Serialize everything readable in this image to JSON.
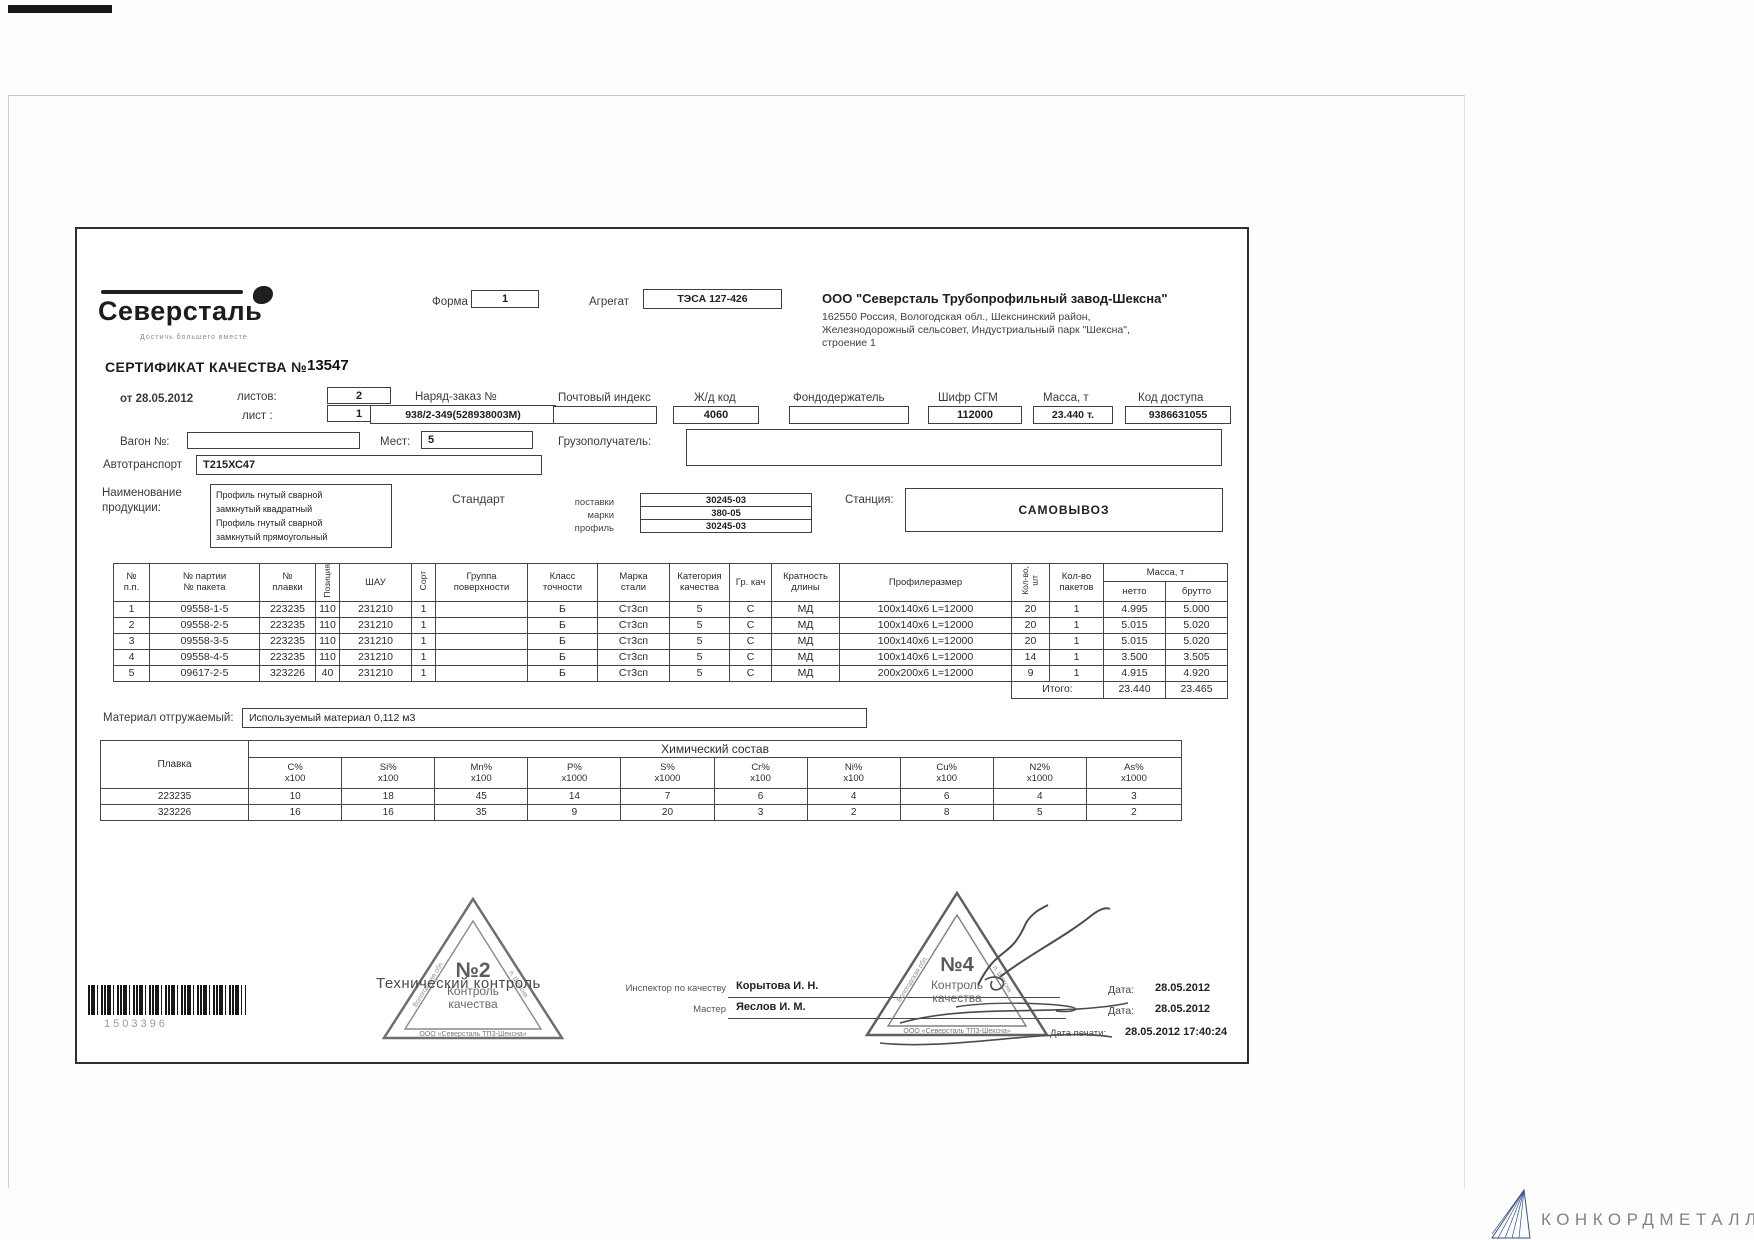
{
  "scan": {
    "barcode_number": "1503396"
  },
  "watermark": {
    "brand": "КОНКОРДМЕТАЛЛ"
  },
  "header": {
    "logo_name": "Северсталь",
    "logo_tagline": "Достичь большего вместе",
    "forma_label": "Форма",
    "forma_value": "1",
    "agregat_label": "Агрегат",
    "agregat_value": "ТЭСА 127-426",
    "company_name": "ООО \"Северсталь Трубопрофильный завод-Шексна\"",
    "company_address_1": "162550 Россия, Вологодская обл., Шекснинский район,",
    "company_address_2": "Железнодорожный сельсовет, Индустриальный парк \"Шексна\",",
    "company_address_3": "строение 1"
  },
  "certificate": {
    "title": "СЕРТИФИКАТ КАЧЕСТВА №",
    "number": "13547",
    "date_line": "от  28.05.2012",
    "listov_label": "листов:",
    "listov": "2",
    "list_label": "лист :",
    "list": "1",
    "order_label": "Наряд-заказ №",
    "order": "938/2-349(528938003М)",
    "postal_label": "Почтовый индекс",
    "postal": "",
    "rail_label": "Ж/д код",
    "rail": "4060",
    "fond_label": "Фондодержатель",
    "fond": "",
    "cipher_label": "Шифр СГМ",
    "cipher": "112000",
    "mass_label": "Масса, т",
    "mass": "23.440 т.",
    "access_label": "Код доступа",
    "access": "9386631055",
    "wagon_label": "Вагон №:",
    "wagon": "",
    "mest_label": "Мест:",
    "mest": "5",
    "consignee_label": "Грузополучатель:",
    "auto_label": "Автотранспорт",
    "auto": "Т215ХС47",
    "product_label_1": "Наименование",
    "product_label_2": "продукции:",
    "product_lines": [
      "Профиль гнутый сварной",
      "замкнутый квадратный",
      "Профиль гнутый сварной",
      "замкнутый прямоугольный"
    ],
    "standard_label": "Стандарт",
    "gost": [
      {
        "label": "поставки",
        "value": "30245-03"
      },
      {
        "label": "марки",
        "value": "380-05"
      },
      {
        "label": "профиль",
        "value": "30245-03"
      }
    ],
    "station_label": "Станция:",
    "station": "САМОВЫВОЗ"
  },
  "main_table": {
    "headers": {
      "num": "№\nп.п.",
      "batch": "№ партии\n№ пакета",
      "melt": "№\nплавки",
      "position": "Позиция",
      "shau": "ШАУ",
      "sort": "Сорт",
      "surface": "Группа\nповерхности",
      "accuracy": "Класс\nточности",
      "steel": "Марка\nстали",
      "category": "Категория\nкачества",
      "gr": "Гр. кач",
      "length": "Кратность\nдлины",
      "profile": "Профилеразмер",
      "qty": "Кол-во,\nшт",
      "packs": "Кол-во\nпакетов",
      "mass": "Масса, т",
      "net": "нетто",
      "gross": "брутто"
    },
    "rows": [
      [
        "1",
        "09558-1-5",
        "223235",
        "110",
        "231210",
        "1",
        "",
        "Б",
        "Ст3сп",
        "5",
        "С",
        "МД",
        "100х140х6 L=12000",
        "20",
        "1",
        "4.995",
        "5.000"
      ],
      [
        "2",
        "09558-2-5",
        "223235",
        "110",
        "231210",
        "1",
        "",
        "Б",
        "Ст3сп",
        "5",
        "С",
        "МД",
        "100х140х6 L=12000",
        "20",
        "1",
        "5.015",
        "5.020"
      ],
      [
        "3",
        "09558-3-5",
        "223235",
        "110",
        "231210",
        "1",
        "",
        "Б",
        "Ст3сп",
        "5",
        "С",
        "МД",
        "100х140х6 L=12000",
        "20",
        "1",
        "5.015",
        "5.020"
      ],
      [
        "4",
        "09558-4-5",
        "223235",
        "110",
        "231210",
        "1",
        "",
        "Б",
        "Ст3сп",
        "5",
        "С",
        "МД",
        "100х140х6 L=12000",
        "14",
        "1",
        "3.500",
        "3.505"
      ],
      [
        "5",
        "09617-2-5",
        "323226",
        "40",
        "231210",
        "1",
        "",
        "Б",
        "Ст3сп",
        "5",
        "С",
        "МД",
        "200х200х6 L=12000",
        "9",
        "1",
        "4.915",
        "4.920"
      ]
    ],
    "totals": {
      "label": "Итого:",
      "net": "23.440",
      "gross": "23.465"
    }
  },
  "material": {
    "label": "Материал отгружаемый:",
    "value": "Используемый материал 0,112 м3"
  },
  "chemistry": {
    "title": "Химический состав",
    "melt_label": "Плавка",
    "columns": [
      {
        "el": "С%",
        "mult": "х100"
      },
      {
        "el": "Si%",
        "mult": "х100"
      },
      {
        "el": "Mn%",
        "mult": "х100"
      },
      {
        "el": "Р%",
        "mult": "х1000"
      },
      {
        "el": "S%",
        "mult": "х1000"
      },
      {
        "el": "Cr%",
        "mult": "х100"
      },
      {
        "el": "Ni%",
        "mult": "х100"
      },
      {
        "el": "Cu%",
        "mult": "х100"
      },
      {
        "el": "N2%",
        "mult": "х1000"
      },
      {
        "el": "As%",
        "mult": "х1000"
      }
    ],
    "rows": [
      {
        "melt": "223235",
        "values": [
          "10",
          "18",
          "45",
          "14",
          "7",
          "6",
          "4",
          "6",
          "4",
          "3"
        ]
      },
      {
        "melt": "323226",
        "values": [
          "16",
          "16",
          "35",
          "9",
          "20",
          "3",
          "2",
          "8",
          "5",
          "2"
        ]
      }
    ]
  },
  "footer": {
    "stamp2": {
      "number": "№2",
      "center1": "Контроль",
      "center2": "качества",
      "bottom": "ООО «Северсталь ТПЗ-Шексна»",
      "left": "Вологодская обл.",
      "right": "п. Шексна"
    },
    "stamp4": {
      "number": "№4",
      "center1": "Контроль",
      "center2": "качества",
      "bottom": "ООО «Северсталь ТПЗ-Шексна»",
      "left": "Вологодская обл.",
      "right": "п. Шексна"
    },
    "tech_control": "Технический контроль",
    "inspector_label": "Инспектор по качеству",
    "inspector": "Корытова И. Н.",
    "master_label": "Мастер",
    "master": "Яеслов И. М.",
    "date1_label": "Дата:",
    "date1": "28.05.2012",
    "date2_label": "Дата:",
    "date2": "28.05.2012",
    "dateprint_label": "Дата печати:",
    "dateprint": "28.05.2012 17:40:24"
  }
}
